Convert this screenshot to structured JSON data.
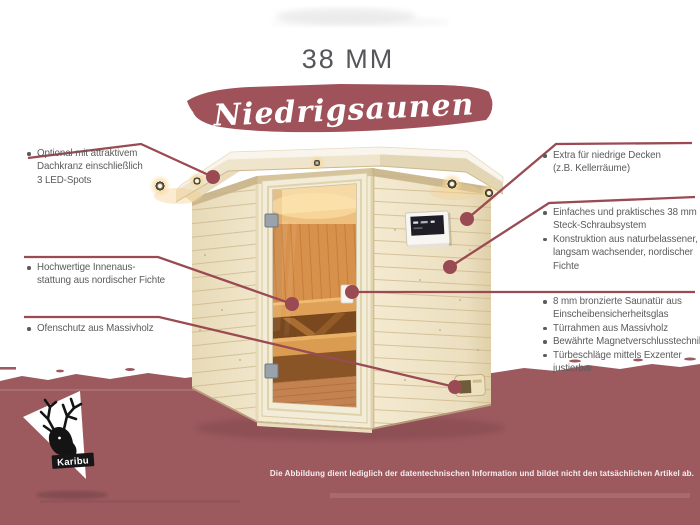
{
  "title": "38 MM",
  "banner": {
    "label": "Niedrigsaunen"
  },
  "annotations": {
    "left": [
      {
        "lines": [
          "Optional mit attraktivem",
          "Dachkranz einschließlich",
          "3 LED-Spots"
        ]
      },
      {
        "lines": [
          "Hochwertige Innenaus-",
          "stattung aus nordischer Fichte"
        ]
      },
      {
        "lines": [
          "Ofenschutz aus Massivholz"
        ]
      }
    ],
    "right": [
      {
        "bullets": [
          {
            "lines": [
              "Extra für niedrige Decken",
              "(z.B. Kellerräume)"
            ]
          }
        ]
      },
      {
        "bullets": [
          {
            "lines": [
              "Einfaches und praktisches 38 mm",
              "Steck-Schraubsystem"
            ]
          },
          {
            "lines": [
              "Konstruktion aus naturbelassener,",
              "langsam wachsender, nordischer",
              "Fichte"
            ]
          }
        ]
      },
      {
        "bullets": [
          {
            "lines": [
              "8 mm bronzierte Saunatür aus",
              "Einscheibensicherheitsglas"
            ]
          },
          {
            "lines": [
              "Türrahmen aus Massivholz"
            ]
          },
          {
            "lines": [
              "Bewährte Magnetverschlusstechnik"
            ]
          },
          {
            "lines": [
              "Türbeschläge mittels Exzenter",
              "justierbar"
            ]
          }
        ]
      }
    ]
  },
  "brand": {
    "name": "Karibu"
  },
  "footer": {
    "disclaimer": "Die Abbildung dient lediglich der datentechnischen Information und bildet nicht den tatsächlichen Artikel ab."
  },
  "colors": {
    "band_maroon": "#9c5a5f",
    "banner_maroon": "#a0525a",
    "callout_line": "#9a4a52",
    "text_gray": "#5b5b5d",
    "wood_light": "#f0e5c9",
    "interior_amber": "#d8914b"
  }
}
